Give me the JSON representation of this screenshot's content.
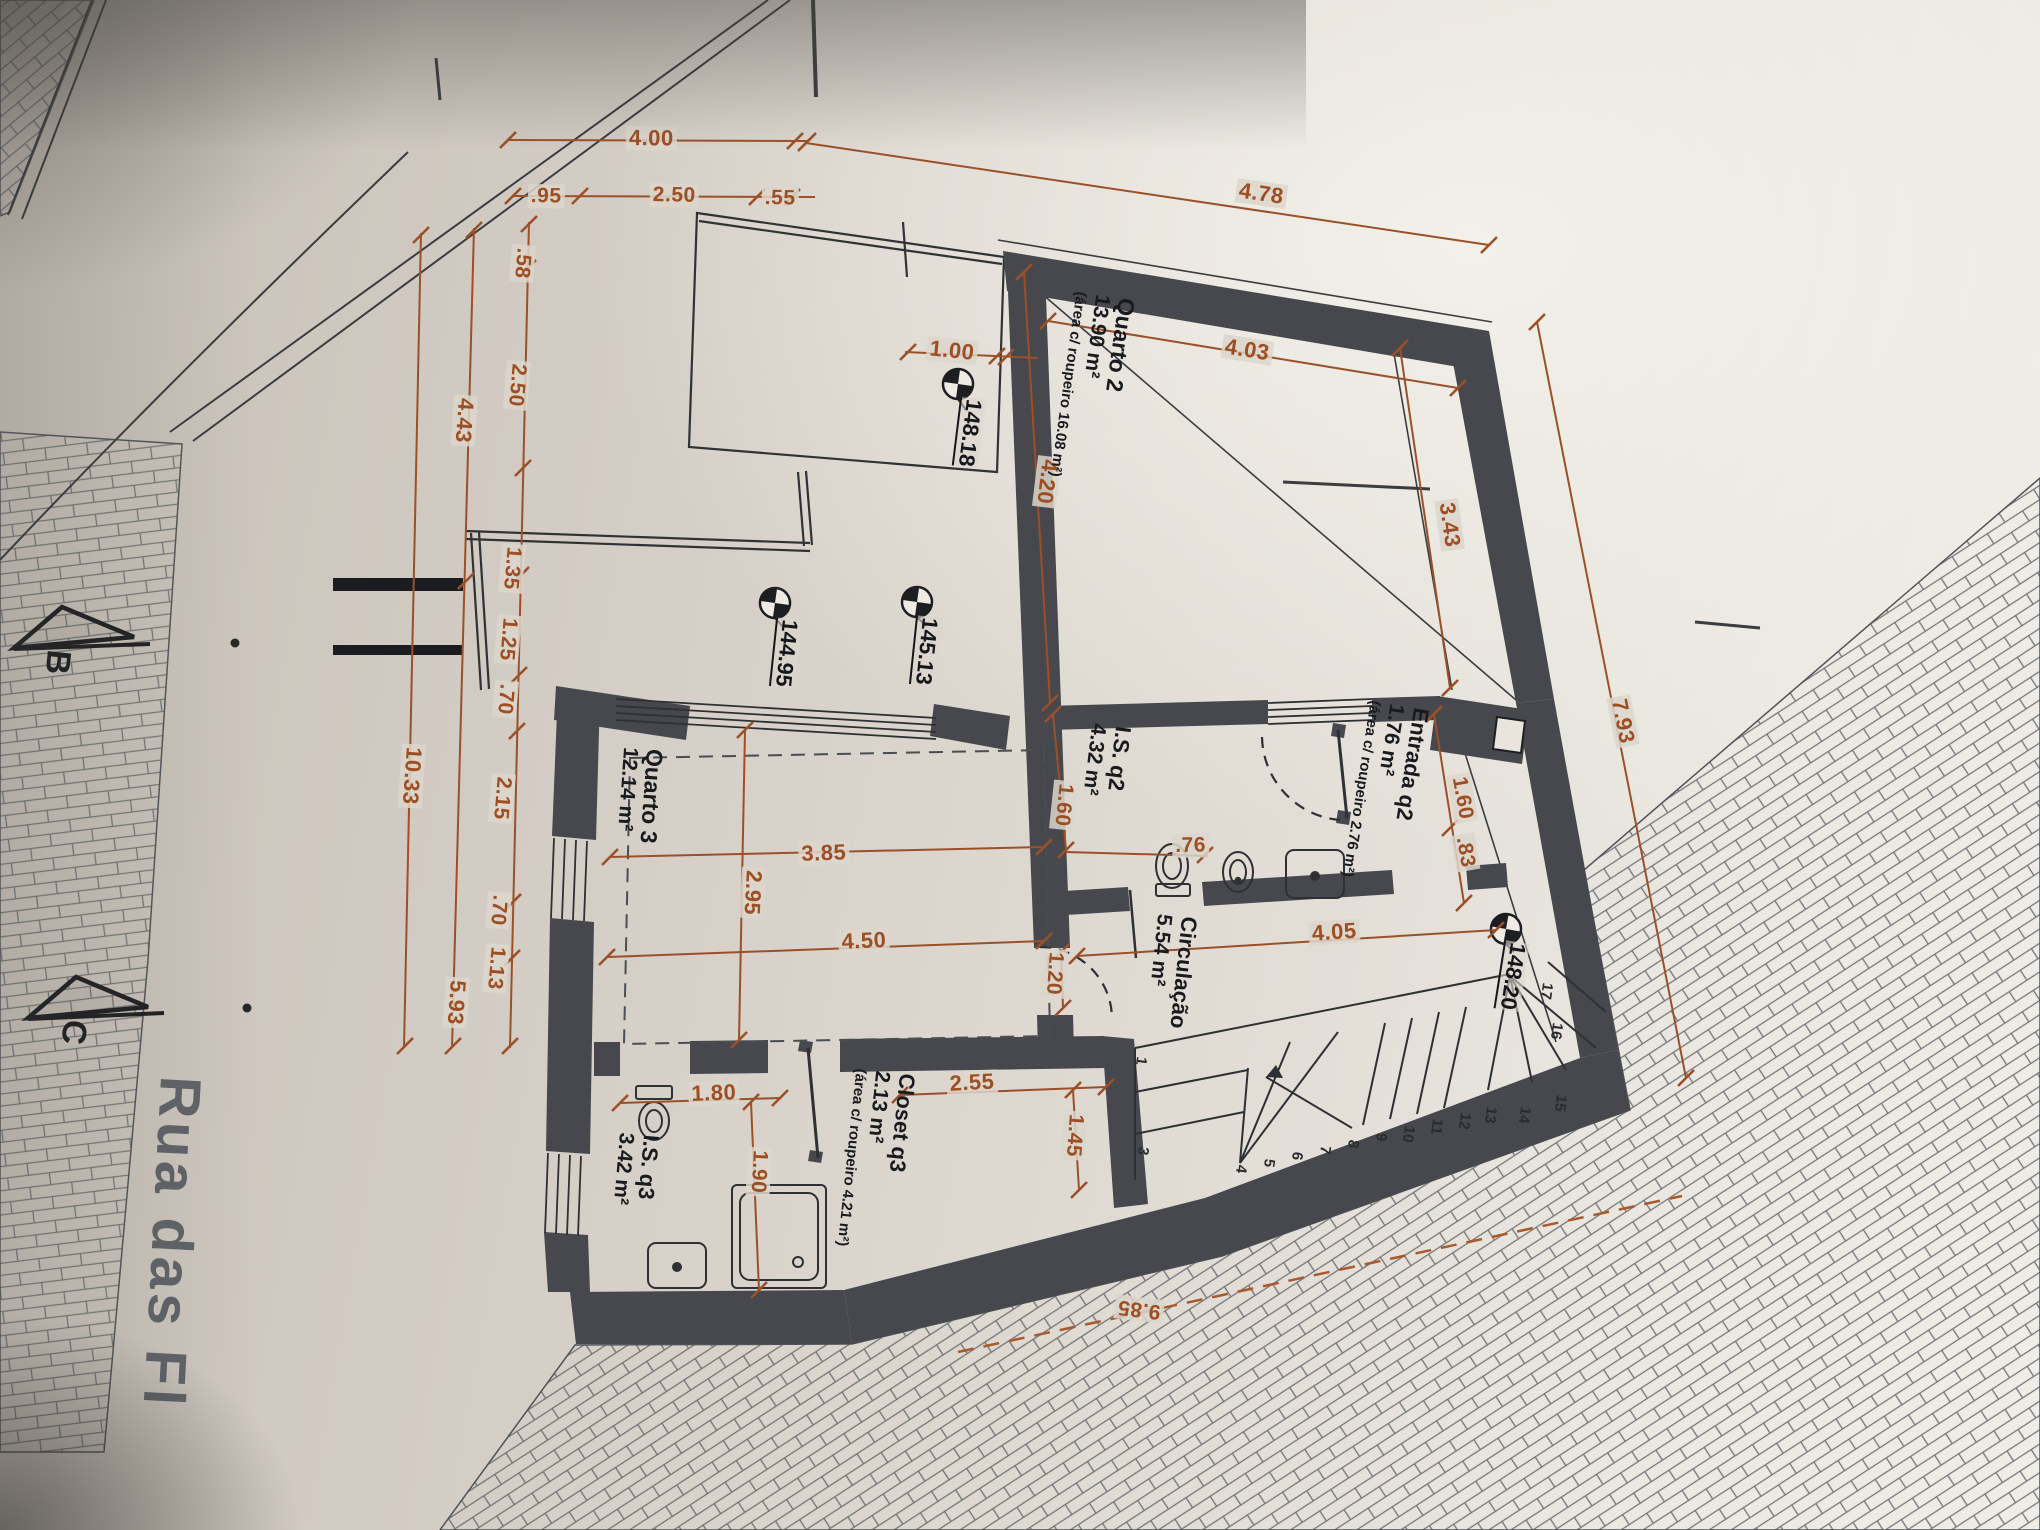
{
  "labels": {
    "quarto2": {
      "name": "Quarto 2",
      "area": "13.90 m²",
      "sub": "(área c/ roupeiro 16.08 m²)"
    },
    "entrada": {
      "name": "Entrada q2",
      "area": "1.76 m²",
      "sub": "(área c/ roupeiro 2.76 m²)"
    },
    "is_q2": {
      "name": "I.S. q2",
      "area": "4.32 m²"
    },
    "circulacao": {
      "name": "Circulação",
      "area": "5.54 m²"
    },
    "quarto3": {
      "name": "Quarto 3",
      "area": "12.14 m²"
    },
    "closet": {
      "name": "Closet q3",
      "area": "2.13 m²",
      "sub": "(área c/ roupeiro 4.21 m²)"
    },
    "is_q3": {
      "name": "I.S. q3",
      "area": "3.42 m²"
    }
  },
  "levels": {
    "v1": "148.18",
    "v2": "144.95",
    "v3": "145.13",
    "v4": "148.20"
  },
  "dims": {
    "top_400": "4.00",
    "top_95": ".95",
    "top_250": "2.50",
    "top_55": ".55",
    "top_478": "4.78",
    "l_58": ".58",
    "l_250": "2.50",
    "l_135": "1.35",
    "l_125": "1.25",
    "l_70a": ".70",
    "l_215": "2.15",
    "l_70b": ".70",
    "l_113": "1.13",
    "m_443": "4.43",
    "m_593": "5.93",
    "o_1033": "10.33",
    "p_100": "1.00",
    "p_403": "4.03",
    "p_420": "4.20",
    "p_343": "3.43",
    "p_160r": "1.60",
    "p_83": ".83",
    "p_793": "7.93",
    "p_160i": "1.60",
    "p_76": ".76",
    "p_385": "3.85",
    "p_295": "2.95",
    "p_450": "4.50",
    "p_120": "1.20",
    "p_405": "4.05",
    "p_255": "2.55",
    "p_145": "1.45",
    "p_180": "1.80",
    "p_190": "1.90",
    "p_985": "9.85"
  },
  "stairs": {
    "numbers": [
      "1",
      "3",
      "4",
      "5",
      "6",
      "7",
      "8",
      "9",
      "10",
      "11",
      "12",
      "13",
      "14",
      "15",
      "16",
      "17"
    ]
  },
  "sections": {
    "b": "B",
    "c": "C"
  },
  "street": {
    "name": "Rua das Fl"
  },
  "colors": {
    "dim_orange": "#9d4e22",
    "wall_gray": "#46484d",
    "ink": "#2e3034",
    "paper": "#d8d2c9"
  }
}
